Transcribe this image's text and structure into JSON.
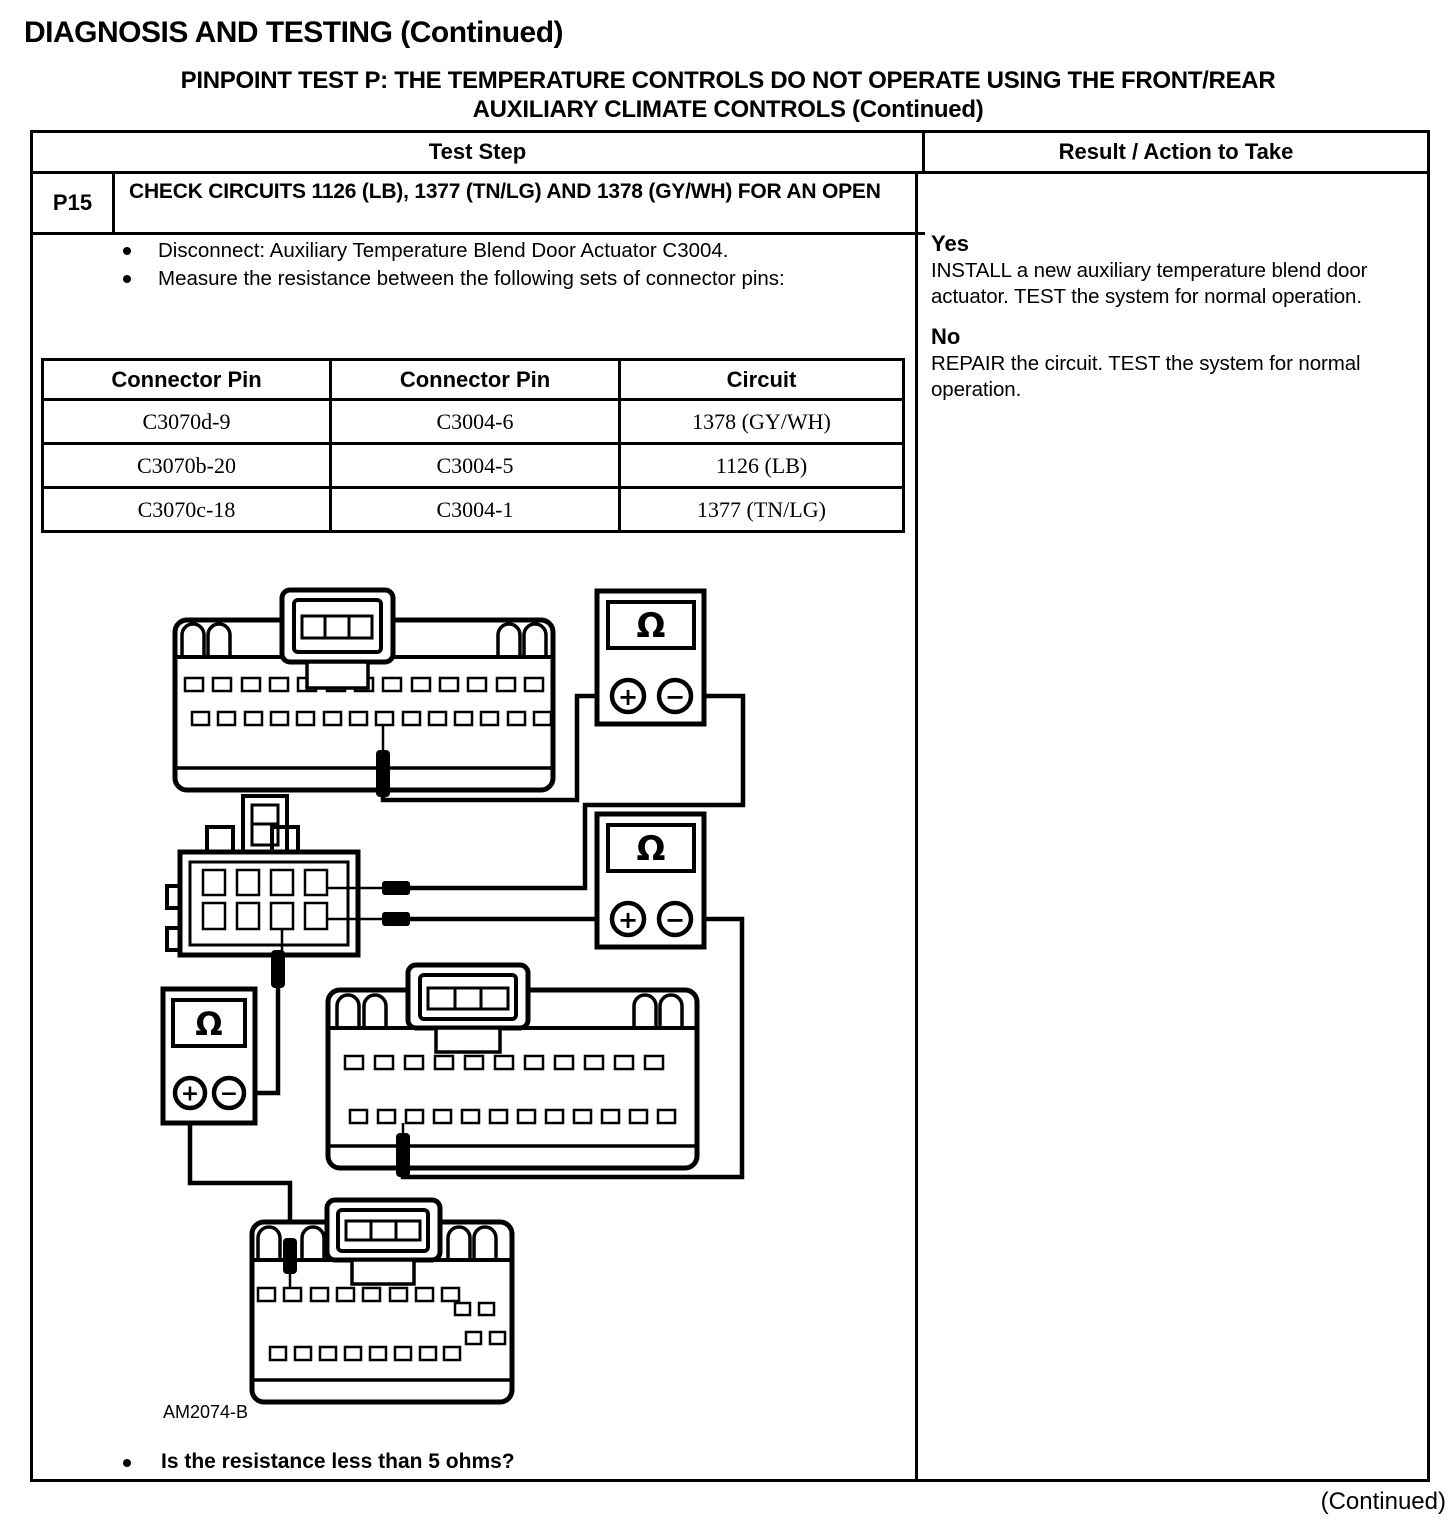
{
  "page": {
    "title": "DIAGNOSIS AND TESTING (Continued)",
    "subtitle_line1": "PINPOINT TEST P: THE TEMPERATURE CONTROLS DO NOT OPERATE USING THE FRONT/REAR",
    "subtitle_line2": "AUXILIARY CLIMATE CONTROLS (Continued)",
    "continued_note": "(Continued)"
  },
  "table": {
    "headers": {
      "test_step": "Test Step",
      "result": "Result / Action to Take"
    },
    "step": {
      "id": "P15",
      "title": "CHECK CIRCUITS 1126 (LB), 1377 (TN/LG) AND 1378 (GY/WH) FOR AN OPEN",
      "bullet1": "Disconnect:  Auxiliary Temperature Blend Door Actuator C3004.",
      "bullet2": "Measure the resistance between the following sets of connector pins:",
      "question": "Is the resistance less than 5 ohms?"
    },
    "pin_table": {
      "col1": "Connector Pin",
      "col2": "Connector Pin",
      "col3": "Circuit",
      "rows": [
        [
          "C3070d-9",
          "C3004-6",
          "1378 (GY/WH)"
        ],
        [
          "C3070b-20",
          "C3004-5",
          "1126 (LB)"
        ],
        [
          "C3070c-18",
          "C3004-1",
          "1377 (TN/LG)"
        ]
      ]
    },
    "result": {
      "yes_label": "Yes",
      "yes_text": "INSTALL a new auxiliary temperature blend door actuator. TEST the system for normal operation.",
      "no_label": "No",
      "no_text": "REPAIR the circuit. TEST the system for normal operation."
    }
  },
  "diagram": {
    "figure_id": "AM2074-B",
    "ohm": "Ω",
    "plus": "+",
    "minus": "−"
  }
}
